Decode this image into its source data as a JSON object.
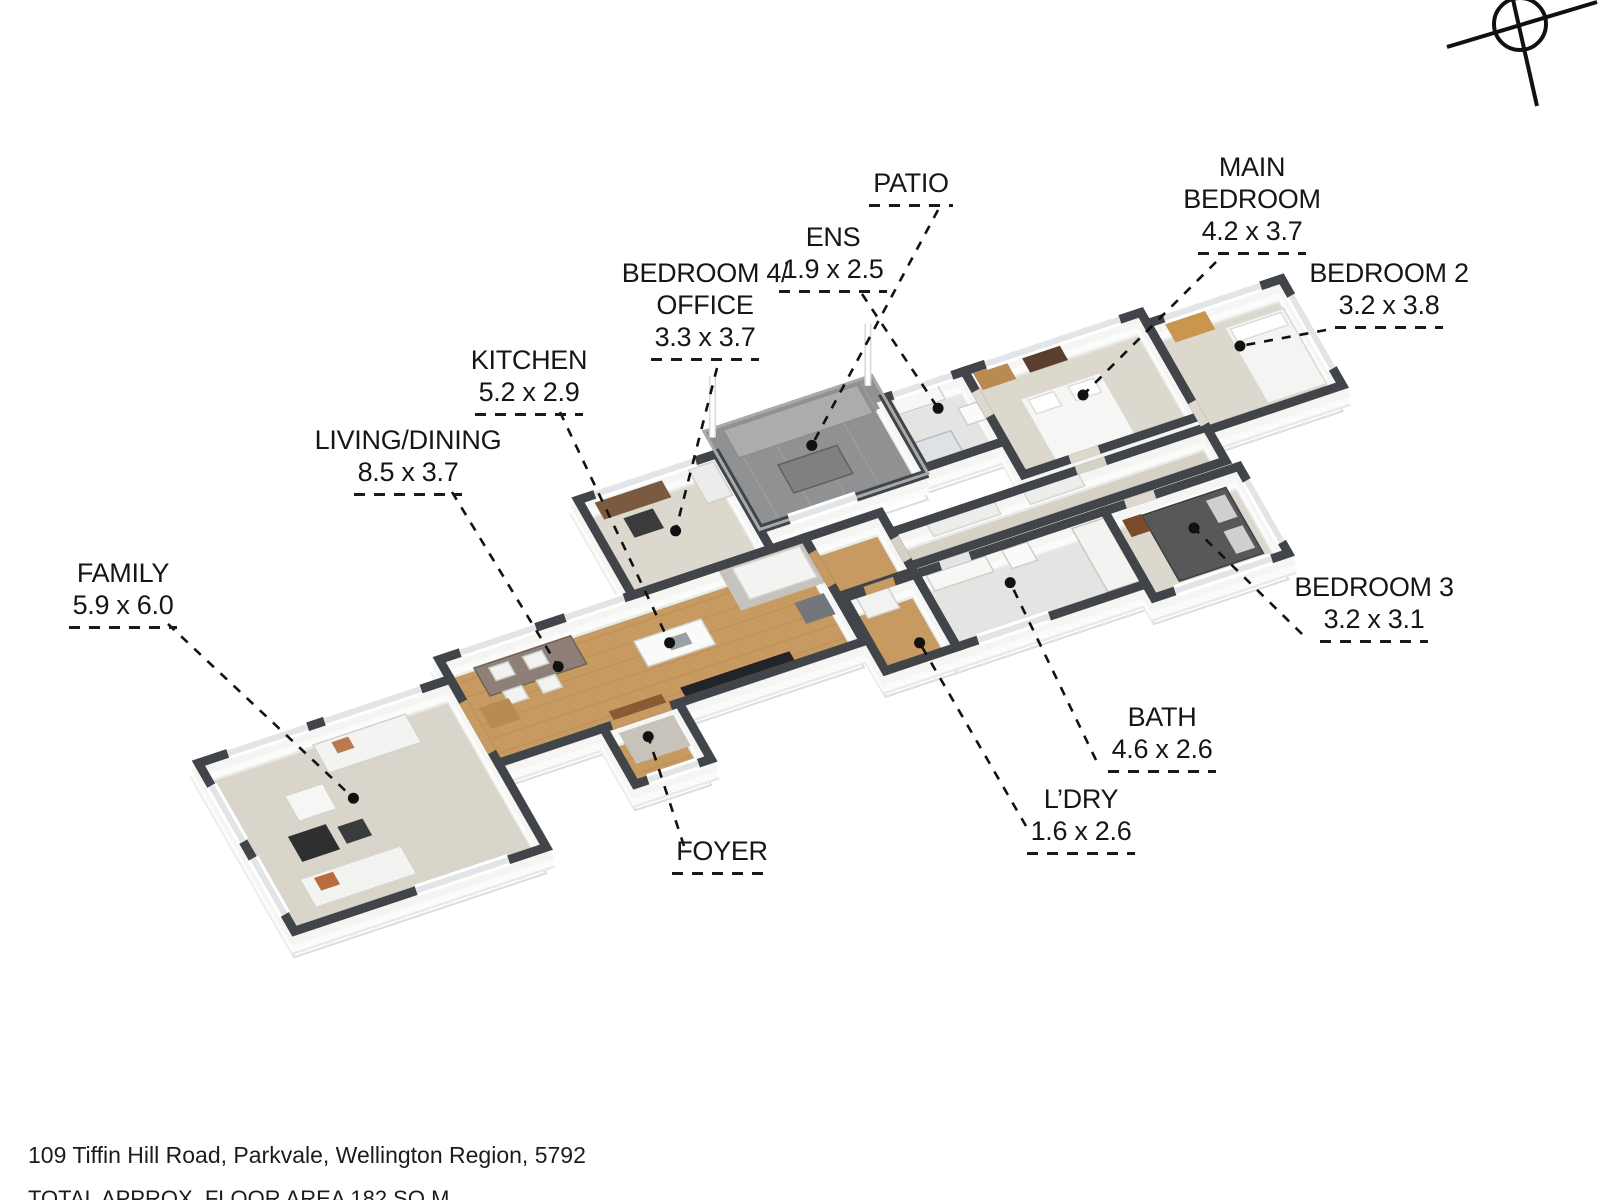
{
  "page": {
    "address": "109 Tiffin Hill Road, Parkvale, Wellington Region, 5792",
    "floor_area": "TOTAL APPROX. FLOOR AREA 182 SQ M"
  },
  "compass": {
    "icon": "compass-icon"
  },
  "rooms": [
    {
      "id": "family",
      "name": "FAMILY",
      "dims": "5.9 x 6.0"
    },
    {
      "id": "living-dining",
      "name": "LIVING/DINING",
      "dims": "8.5 x 3.7"
    },
    {
      "id": "kitchen",
      "name": "KITCHEN",
      "dims": "5.2 x 2.9"
    },
    {
      "id": "foyer",
      "name": "FOYER",
      "dims": ""
    },
    {
      "id": "bedroom-4-office",
      "name": "BEDROOM 4/ OFFICE",
      "dims": "3.3 x 3.7"
    },
    {
      "id": "ens",
      "name": "ENS",
      "dims": "1.9 x 2.5"
    },
    {
      "id": "patio",
      "name": "PATIO",
      "dims": ""
    },
    {
      "id": "main-bedroom",
      "name": "MAIN BEDROOM",
      "dims": "4.2 x 3.7"
    },
    {
      "id": "bedroom-2",
      "name": "BEDROOM 2",
      "dims": "3.2 x 3.8"
    },
    {
      "id": "bedroom-3",
      "name": "BEDROOM 3",
      "dims": "3.2 x 3.1"
    },
    {
      "id": "bath",
      "name": "BATH",
      "dims": "4.6 x 2.6"
    },
    {
      "id": "ldry",
      "name": "L’DRY",
      "dims": "1.6 x 2.6"
    }
  ],
  "colors": {
    "wall_top": "#41454a",
    "wood_floor": "#c69a60",
    "carpet_family": "#d9d5cb",
    "carpet_bedroom": "#ddd8cd",
    "corridor": "#d6d1c6",
    "tile": "#e4e4e2",
    "deck": "#8f9192",
    "label_text": "#161616",
    "leader": "#111111"
  }
}
